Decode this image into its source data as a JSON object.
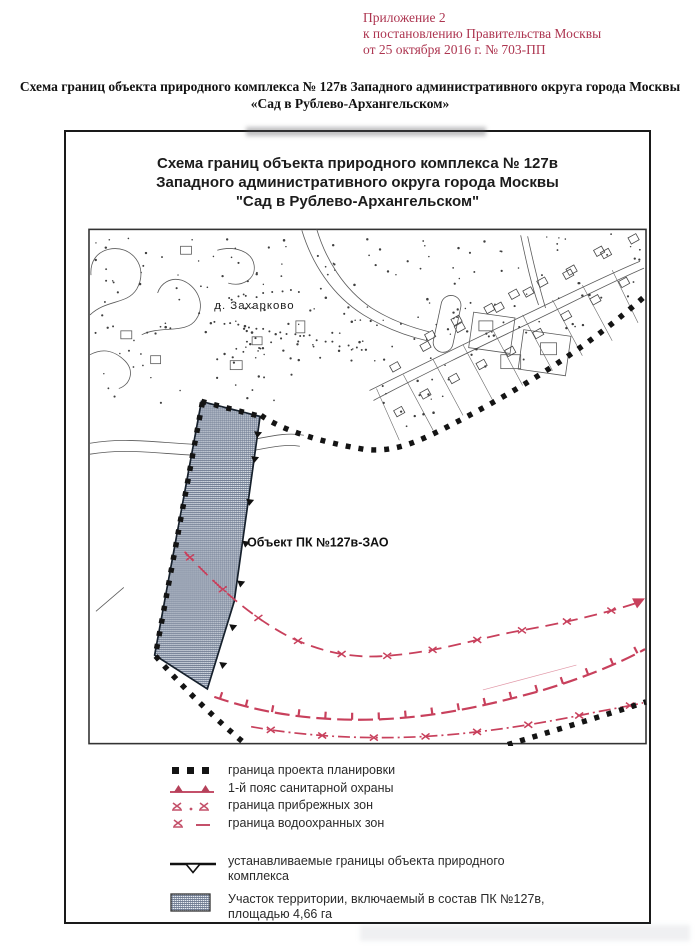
{
  "annotation": {
    "color": "#ad3550",
    "lines": [
      "Приложение 2",
      "к постановлению Правительства Москвы",
      "от 25 октября 2016 г. № 703-ПП"
    ]
  },
  "document_title": {
    "lines": [
      "Схема границ объекта природного комплекса № 127в Западного административного округа города Москвы",
      "«Сад в Рублево-Архангельском»"
    ]
  },
  "panel": {
    "title_lines": [
      "Схема границ объекта природного комплекса № 127в",
      "Западного административного округа города Москвы",
      "\"Сад в Рублево-Архангельском\""
    ],
    "map": {
      "village_label": "д. Захарково",
      "object_label": "Объект ПК №127в-ЗАО"
    }
  },
  "legend": {
    "items": [
      {
        "name": "project-boundary",
        "label": "граница проекта планировки"
      },
      {
        "name": "sanitary-belt",
        "label": "1-й пояс санитарной охраны"
      },
      {
        "name": "coastal-zone",
        "label": "граница прибрежных зон"
      },
      {
        "name": "water-protection-zone",
        "label": "граница водоохранных зон"
      },
      {
        "name": "established-boundaries",
        "label": "устанавливаемые границы объекта природного комплекса"
      },
      {
        "name": "included-parcel",
        "label": "Участок территории, включаемый в состав ПК №127в, площадью 4,66 га"
      }
    ]
  },
  "colors": {
    "boundary_black": "#141414",
    "map_red": "#c8405c",
    "legend_red": "#c4506a",
    "hatch_line": "#53617a"
  }
}
